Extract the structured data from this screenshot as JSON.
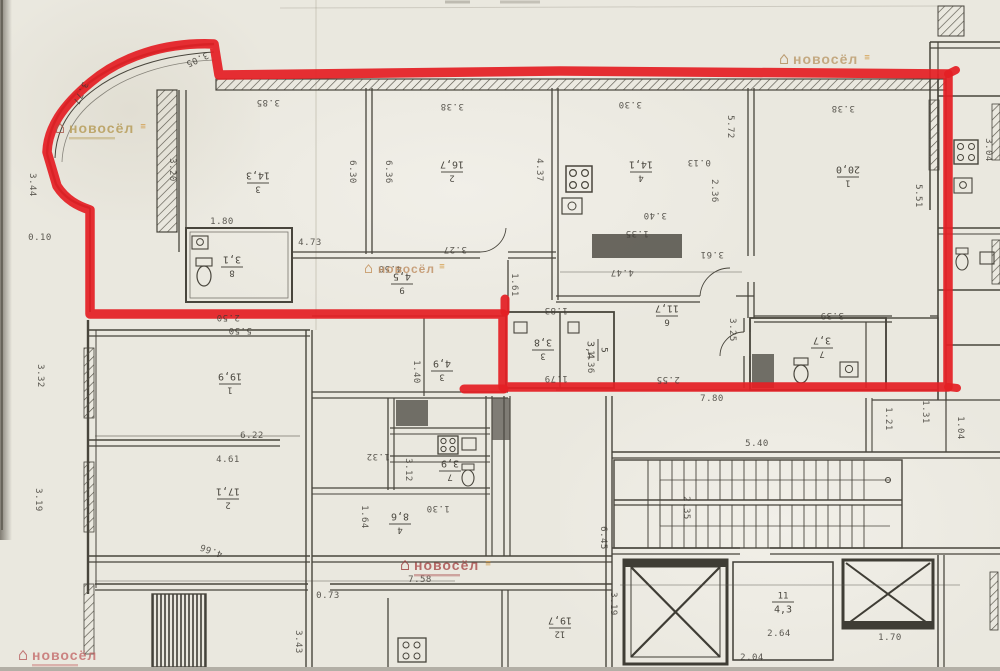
{
  "plan": {
    "kind": "scanned floor plan with highlighted apartment",
    "red_outline_color": "#e41f25",
    "ink_color": "#3b3831",
    "paper_color": "#eae8df"
  },
  "watermark": {
    "brand": "новосёл"
  },
  "watermarks": [
    {
      "x": 55,
      "y": 133,
      "size": 14,
      "color": "#b59a54",
      "icon_color": "#a85648",
      "mark": true,
      "subline": true
    },
    {
      "x": 779,
      "y": 64,
      "size": 14,
      "color": "#bb9a6a",
      "icon_color": "#b08a58",
      "mark": true,
      "subline": false
    },
    {
      "x": 364,
      "y": 273,
      "size": 12,
      "color": "#bf8e62",
      "icon_color": "#c08a50",
      "mark": true,
      "subline": false
    },
    {
      "x": 400,
      "y": 570,
      "size": 14,
      "color": "#a84a4a",
      "icon_color": "#9c3c3c",
      "mark": true,
      "subline": true
    },
    {
      "x": 18,
      "y": 660,
      "size": 14,
      "color": "#c46a6a",
      "icon_color": "#b85c5c",
      "mark": false,
      "subline": true
    }
  ],
  "room_labels": [
    {
      "num": "3",
      "area": "14,3",
      "x": 258,
      "y": 183,
      "rot": 180
    },
    {
      "num": "2",
      "area": "16,7",
      "x": 452,
      "y": 172,
      "rot": 180
    },
    {
      "num": "4",
      "area": "14,1",
      "x": 641,
      "y": 172,
      "rot": 180
    },
    {
      "num": "1",
      "area": "20,0",
      "x": 848,
      "y": 177,
      "rot": 180
    },
    {
      "num": "8",
      "area": "3,1",
      "x": 232,
      "y": 267,
      "rot": 180
    },
    {
      "num": "9",
      "area": "4,5",
      "x": 402,
      "y": 284,
      "rot": 180
    },
    {
      "num": "3",
      "area": "3,8",
      "x": 543,
      "y": 350,
      "rot": 180
    },
    {
      "num": "5",
      "area": "3,4",
      "x": 598,
      "y": 350,
      "rot": 90
    },
    {
      "num": "6",
      "area": "11,7",
      "x": 667,
      "y": 316,
      "rot": 180
    },
    {
      "num": "7",
      "area": "3,7",
      "x": 822,
      "y": 348,
      "rot": 180
    },
    {
      "num": "1",
      "area": "19,9",
      "x": 230,
      "y": 384,
      "rot": 180
    },
    {
      "num": "2",
      "area": "17,1",
      "x": 228,
      "y": 499,
      "rot": 180
    },
    {
      "num": "3",
      "area": "4,9",
      "x": 442,
      "y": 371,
      "rot": 180
    },
    {
      "num": "7",
      "area": "3,9",
      "x": 450,
      "y": 471,
      "rot": 180
    },
    {
      "num": "4",
      "area": "8,6",
      "x": 400,
      "y": 524,
      "rot": 180
    },
    {
      "num": "12",
      "area": "19,7",
      "x": 560,
      "y": 628,
      "rot": 180
    },
    {
      "num": "11",
      "area": "4,3",
      "x": 783,
      "y": 602,
      "rot": 0
    }
  ],
  "dimensions": [
    {
      "text": "3.85",
      "x": 268,
      "y": 100,
      "rot": 180
    },
    {
      "text": "3.38",
      "x": 452,
      "y": 104,
      "rot": 180
    },
    {
      "text": "3.30",
      "x": 630,
      "y": 102,
      "rot": 180
    },
    {
      "text": "3.38",
      "x": 843,
      "y": 106,
      "rot": 180
    },
    {
      "text": "5.51",
      "x": 916,
      "y": 196,
      "rot": 90
    },
    {
      "text": "3.05",
      "x": 196,
      "y": 57,
      "rot": 155
    },
    {
      "text": "3.77",
      "x": 78,
      "y": 92,
      "rot": 115
    },
    {
      "text": "0.10",
      "x": 40,
      "y": 240,
      "rot": 0
    },
    {
      "text": "3.44",
      "x": 30,
      "y": 185,
      "rot": 90
    },
    {
      "text": "3.20",
      "x": 170,
      "y": 170,
      "rot": 90
    },
    {
      "text": "6.30",
      "x": 350,
      "y": 172,
      "rot": 90
    },
    {
      "text": "6.36",
      "x": 386,
      "y": 172,
      "rot": 90
    },
    {
      "text": "4.37",
      "x": 537,
      "y": 170,
      "rot": 90
    },
    {
      "text": "5.72",
      "x": 728,
      "y": 127,
      "rot": 90
    },
    {
      "text": "0.13",
      "x": 699,
      "y": 160,
      "rot": 180
    },
    {
      "text": "2.36",
      "x": 712,
      "y": 191,
      "rot": 90
    },
    {
      "text": "3.40",
      "x": 655,
      "y": 213,
      "rot": 180
    },
    {
      "text": "1.35",
      "x": 637,
      "y": 231,
      "rot": 180
    },
    {
      "text": "1.80",
      "x": 222,
      "y": 224,
      "rot": 0
    },
    {
      "text": "4.73",
      "x": 310,
      "y": 245,
      "rot": 0
    },
    {
      "text": "3.27",
      "x": 455,
      "y": 247,
      "rot": 180
    },
    {
      "text": "4.47",
      "x": 622,
      "y": 270,
      "rot": 180
    },
    {
      "text": "3.61",
      "x": 712,
      "y": 252,
      "rot": 180
    },
    {
      "text": "1.61",
      "x": 512,
      "y": 285,
      "rot": 90
    },
    {
      "text": "4.50",
      "x": 390,
      "y": 266,
      "rot": 180
    },
    {
      "text": "2.50",
      "x": 228,
      "y": 315,
      "rot": 180
    },
    {
      "text": "1.83",
      "x": 556,
      "y": 308,
      "rot": 180
    },
    {
      "text": "1.79",
      "x": 556,
      "y": 376,
      "rot": 180
    },
    {
      "text": "1.36",
      "x": 588,
      "y": 362,
      "rot": 90
    },
    {
      "text": "3.25",
      "x": 730,
      "y": 330,
      "rot": 90
    },
    {
      "text": "2.55",
      "x": 668,
      "y": 377,
      "rot": 180
    },
    {
      "text": "3.39",
      "x": 832,
      "y": 313,
      "rot": 180
    },
    {
      "text": "7.80",
      "x": 712,
      "y": 401,
      "rot": 0
    },
    {
      "text": "1.21",
      "x": 886,
      "y": 419,
      "rot": 90
    },
    {
      "text": "1.31",
      "x": 923,
      "y": 412,
      "rot": 90
    },
    {
      "text": "1.04",
      "x": 958,
      "y": 428,
      "rot": 90
    },
    {
      "text": "3.04",
      "x": 986,
      "y": 150,
      "rot": 90
    },
    {
      "text": "5.50",
      "x": 240,
      "y": 328,
      "rot": 180
    },
    {
      "text": "3.32",
      "x": 38,
      "y": 376,
      "rot": 90
    },
    {
      "text": "3.19",
      "x": 36,
      "y": 500,
      "rot": 90
    },
    {
      "text": "6.22",
      "x": 252,
      "y": 438,
      "rot": 0
    },
    {
      "text": "4.61",
      "x": 228,
      "y": 462,
      "rot": 0
    },
    {
      "text": "4.66",
      "x": 212,
      "y": 548,
      "rot": 200
    },
    {
      "text": "1.40",
      "x": 414,
      "y": 372,
      "rot": 90
    },
    {
      "text": "1.32",
      "x": 378,
      "y": 454,
      "rot": 180
    },
    {
      "text": "3.12",
      "x": 406,
      "y": 470,
      "rot": 90
    },
    {
      "text": "1.30",
      "x": 438,
      "y": 506,
      "rot": 180
    },
    {
      "text": "1.64",
      "x": 362,
      "y": 517,
      "rot": 90
    },
    {
      "text": "5.40",
      "x": 757,
      "y": 446,
      "rot": 0
    },
    {
      "text": "2.35",
      "x": 684,
      "y": 508,
      "rot": 90
    },
    {
      "text": "6.45",
      "x": 601,
      "y": 538,
      "rot": 90
    },
    {
      "text": "0.73",
      "x": 328,
      "y": 598,
      "rot": 0
    },
    {
      "text": "7.58",
      "x": 420,
      "y": 582,
      "rot": 0
    },
    {
      "text": "3.43",
      "x": 296,
      "y": 642,
      "rot": 90
    },
    {
      "text": "3.19",
      "x": 611,
      "y": 604,
      "rot": 90
    },
    {
      "text": "2.64",
      "x": 779,
      "y": 636,
      "rot": 0
    },
    {
      "text": "1.70",
      "x": 890,
      "y": 640,
      "rot": 0
    },
    {
      "text": "2.04",
      "x": 752,
      "y": 660,
      "rot": 0
    }
  ]
}
